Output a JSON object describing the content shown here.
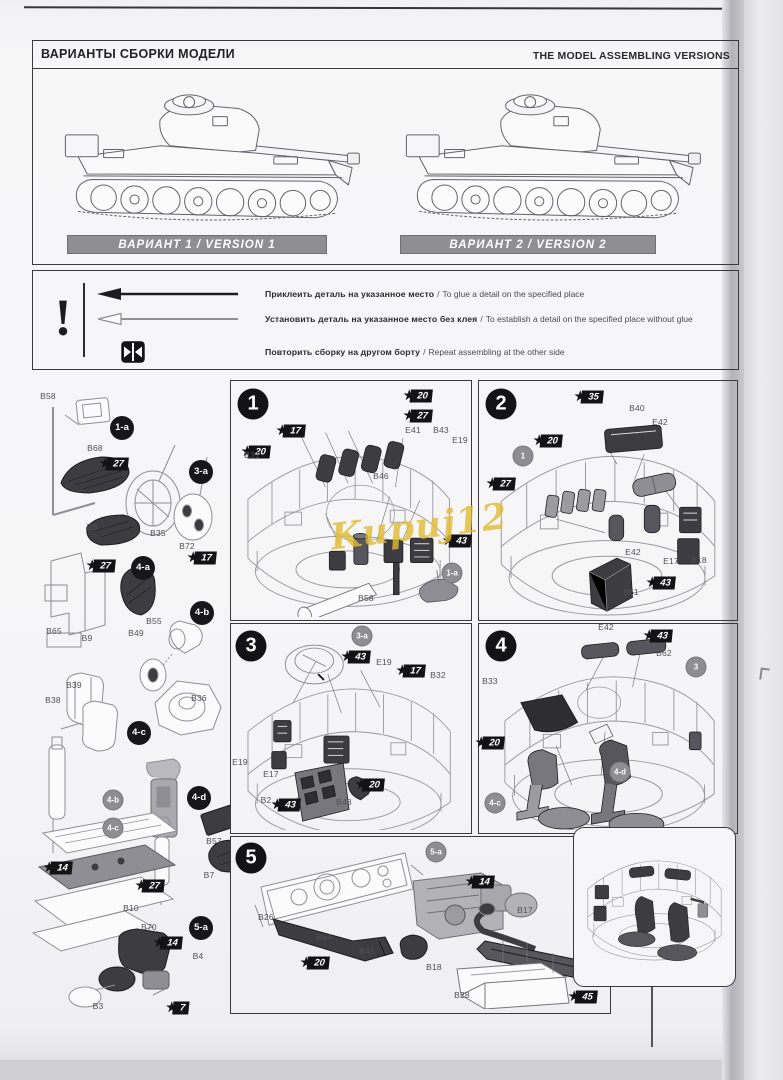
{
  "header": {
    "title_ru": "ВАРИАНТЫ СБОРКИ МОДЕЛИ",
    "title_en": "THE MODEL ASSEMBLING VERSIONS"
  },
  "versions": [
    {
      "label": "ВАРИАНТ 1 / VERSION 1"
    },
    {
      "label": "ВАРИАНТ 2 / VERSION 2"
    }
  ],
  "legend": {
    "mark": "!",
    "rows": [
      {
        "icon": "glue-arrow",
        "ru": "Приклеить деталь на указанное место",
        "sep": "/",
        "en": "To glue a detail on the specified place"
      },
      {
        "icon": "no-glue-arrow",
        "ru": "Установить деталь на указанное место без клея",
        "sep": "/",
        "en": "To establish a detail on the specified place without glue"
      },
      {
        "icon": "repeat-side",
        "ru": "Повторить сборку на другом борту",
        "sep": "/",
        "en": "Repeat assembling at the other side"
      }
    ]
  },
  "watermark": "Kupuj12",
  "colors": {
    "paper": "#f6f6f8",
    "ink": "#1c1c1e",
    "version_bar": "#8f8f93",
    "badge_black": "#131316",
    "ref_gray": "#8d8d92",
    "watermark_yellow": "#e2bb31"
  },
  "annotations": [
    {
      "t": "part",
      "s": "B58",
      "x": 48,
      "y": 396
    },
    {
      "t": "sub",
      "s": "1-a",
      "x": 122,
      "y": 428
    },
    {
      "t": "part",
      "s": "B68",
      "x": 95,
      "y": 448
    },
    {
      "t": "badge",
      "s": "27",
      "x": 117,
      "y": 464
    },
    {
      "t": "sub",
      "s": "3-a",
      "x": 201,
      "y": 472
    },
    {
      "t": "part",
      "s": "B6",
      "x": 92,
      "y": 527
    },
    {
      "t": "part",
      "s": "B35",
      "x": 158,
      "y": 533
    },
    {
      "t": "part",
      "s": "B72",
      "x": 187,
      "y": 546
    },
    {
      "t": "badge",
      "s": "17",
      "x": 205,
      "y": 558
    },
    {
      "t": "badge",
      "s": "27",
      "x": 104,
      "y": 566
    },
    {
      "t": "sub",
      "s": "4-a",
      "x": 143,
      "y": 568
    },
    {
      "t": "sub",
      "s": "4-b",
      "x": 202,
      "y": 613
    },
    {
      "t": "part",
      "s": "B65",
      "x": 54,
      "y": 631
    },
    {
      "t": "part",
      "s": "B9",
      "x": 87,
      "y": 638
    },
    {
      "t": "part",
      "s": "B55",
      "x": 154,
      "y": 621
    },
    {
      "t": "part",
      "s": "B49",
      "x": 136,
      "y": 633
    },
    {
      "t": "part",
      "s": "B36",
      "x": 199,
      "y": 698
    },
    {
      "t": "part",
      "s": "B39",
      "x": 74,
      "y": 685
    },
    {
      "t": "part",
      "s": "B38",
      "x": 53,
      "y": 700
    },
    {
      "t": "sub",
      "s": "4-c",
      "x": 139,
      "y": 733
    },
    {
      "t": "ref",
      "s": "4-b",
      "x": 113,
      "y": 800
    },
    {
      "t": "sub",
      "s": "4-d",
      "x": 199,
      "y": 798
    },
    {
      "t": "ref",
      "s": "4-c",
      "x": 113,
      "y": 828
    },
    {
      "t": "part",
      "s": "B57",
      "x": 214,
      "y": 841
    },
    {
      "t": "badge",
      "s": "14",
      "x": 61,
      "y": 868
    },
    {
      "t": "part",
      "s": "B7",
      "x": 209,
      "y": 875
    },
    {
      "t": "badge",
      "s": "27",
      "x": 153,
      "y": 886
    },
    {
      "t": "part",
      "s": "B10",
      "x": 131,
      "y": 908
    },
    {
      "t": "part",
      "s": "B70",
      "x": 149,
      "y": 927
    },
    {
      "t": "sub",
      "s": "5-a",
      "x": 201,
      "y": 928
    },
    {
      "t": "badge",
      "s": "14",
      "x": 171,
      "y": 943
    },
    {
      "t": "part",
      "s": "B4",
      "x": 198,
      "y": 956
    },
    {
      "t": "part",
      "s": "B3",
      "x": 98,
      "y": 1006
    },
    {
      "t": "badge",
      "s": "7",
      "x": 181,
      "y": 1008
    },
    {
      "t": "step",
      "s": "1",
      "x": 253,
      "y": 404
    },
    {
      "t": "badge",
      "s": "20",
      "x": 421,
      "y": 396
    },
    {
      "t": "badge",
      "s": "27",
      "x": 421,
      "y": 416
    },
    {
      "t": "badge",
      "s": "17",
      "x": 294,
      "y": 431
    },
    {
      "t": "badge",
      "s": "20",
      "x": 259,
      "y": 452
    },
    {
      "t": "part",
      "s": "E41",
      "x": 413,
      "y": 430
    },
    {
      "t": "part",
      "s": "B43",
      "x": 441,
      "y": 430
    },
    {
      "t": "part",
      "s": "E19",
      "x": 460,
      "y": 440
    },
    {
      "t": "part",
      "s": "B31",
      "x": 252,
      "y": 455
    },
    {
      "t": "part",
      "s": "B46",
      "x": 381,
      "y": 476
    },
    {
      "t": "part",
      "s": "B58",
      "x": 366,
      "y": 598
    },
    {
      "t": "badge",
      "s": "43",
      "x": 460,
      "y": 541
    },
    {
      "t": "ref",
      "s": "1-a",
      "x": 452,
      "y": 573
    },
    {
      "t": "step",
      "s": "2",
      "x": 501,
      "y": 404
    },
    {
      "t": "badge",
      "s": "35",
      "x": 592,
      "y": 397
    },
    {
      "t": "part",
      "s": "B40",
      "x": 637,
      "y": 408
    },
    {
      "t": "badge",
      "s": "20",
      "x": 551,
      "y": 441
    },
    {
      "t": "ref",
      "s": "1",
      "x": 523,
      "y": 456
    },
    {
      "t": "part",
      "s": "E42",
      "x": 660,
      "y": 422
    },
    {
      "t": "badge",
      "s": "27",
      "x": 504,
      "y": 484
    },
    {
      "t": "part",
      "s": "E42",
      "x": 633,
      "y": 552
    },
    {
      "t": "part",
      "s": "E17",
      "x": 671,
      "y": 561
    },
    {
      "t": "part",
      "s": "E18",
      "x": 699,
      "y": 560
    },
    {
      "t": "part",
      "s": "B61",
      "x": 631,
      "y": 592
    },
    {
      "t": "badge",
      "s": "43",
      "x": 664,
      "y": 583
    },
    {
      "t": "step",
      "s": "3",
      "x": 251,
      "y": 646
    },
    {
      "t": "ref",
      "s": "3-a",
      "x": 362,
      "y": 636
    },
    {
      "t": "badge",
      "s": "43",
      "x": 359,
      "y": 657
    },
    {
      "t": "part",
      "s": "E19",
      "x": 384,
      "y": 662
    },
    {
      "t": "badge",
      "s": "17",
      "x": 414,
      "y": 671
    },
    {
      "t": "part",
      "s": "B32",
      "x": 438,
      "y": 675
    },
    {
      "t": "part",
      "s": "E19",
      "x": 240,
      "y": 762
    },
    {
      "t": "part",
      "s": "E17",
      "x": 271,
      "y": 774
    },
    {
      "t": "part",
      "s": "B2",
      "x": 266,
      "y": 800
    },
    {
      "t": "badge",
      "s": "43",
      "x": 289,
      "y": 805
    },
    {
      "t": "part",
      "s": "B48",
      "x": 344,
      "y": 802
    },
    {
      "t": "badge",
      "s": "20",
      "x": 373,
      "y": 785
    },
    {
      "t": "step",
      "s": "4",
      "x": 501,
      "y": 646
    },
    {
      "t": "part",
      "s": "E42",
      "x": 606,
      "y": 627
    },
    {
      "t": "badge",
      "s": "43",
      "x": 661,
      "y": 636
    },
    {
      "t": "part",
      "s": "B62",
      "x": 664,
      "y": 653
    },
    {
      "t": "ref",
      "s": "3",
      "x": 696,
      "y": 667
    },
    {
      "t": "part",
      "s": "B33",
      "x": 490,
      "y": 681
    },
    {
      "t": "badge",
      "s": "20",
      "x": 493,
      "y": 743
    },
    {
      "t": "ref",
      "s": "4-c",
      "x": 495,
      "y": 803
    },
    {
      "t": "ref",
      "s": "4-d",
      "x": 620,
      "y": 772
    },
    {
      "t": "step",
      "s": "5",
      "x": 251,
      "y": 858
    },
    {
      "t": "ref",
      "s": "5-a",
      "x": 436,
      "y": 852
    },
    {
      "t": "part",
      "s": "B26",
      "x": 266,
      "y": 917
    },
    {
      "t": "part",
      "s": "B64",
      "x": 324,
      "y": 937
    },
    {
      "t": "part",
      "s": "B45",
      "x": 367,
      "y": 951
    },
    {
      "t": "badge",
      "s": "20",
      "x": 318,
      "y": 963
    },
    {
      "t": "badge",
      "s": "14",
      "x": 483,
      "y": 882
    },
    {
      "t": "part",
      "s": "B17",
      "x": 525,
      "y": 910
    },
    {
      "t": "part",
      "s": "B18",
      "x": 434,
      "y": 967
    },
    {
      "t": "part",
      "s": "B28",
      "x": 462,
      "y": 995
    },
    {
      "t": "badge",
      "s": "45",
      "x": 586,
      "y": 997
    }
  ]
}
